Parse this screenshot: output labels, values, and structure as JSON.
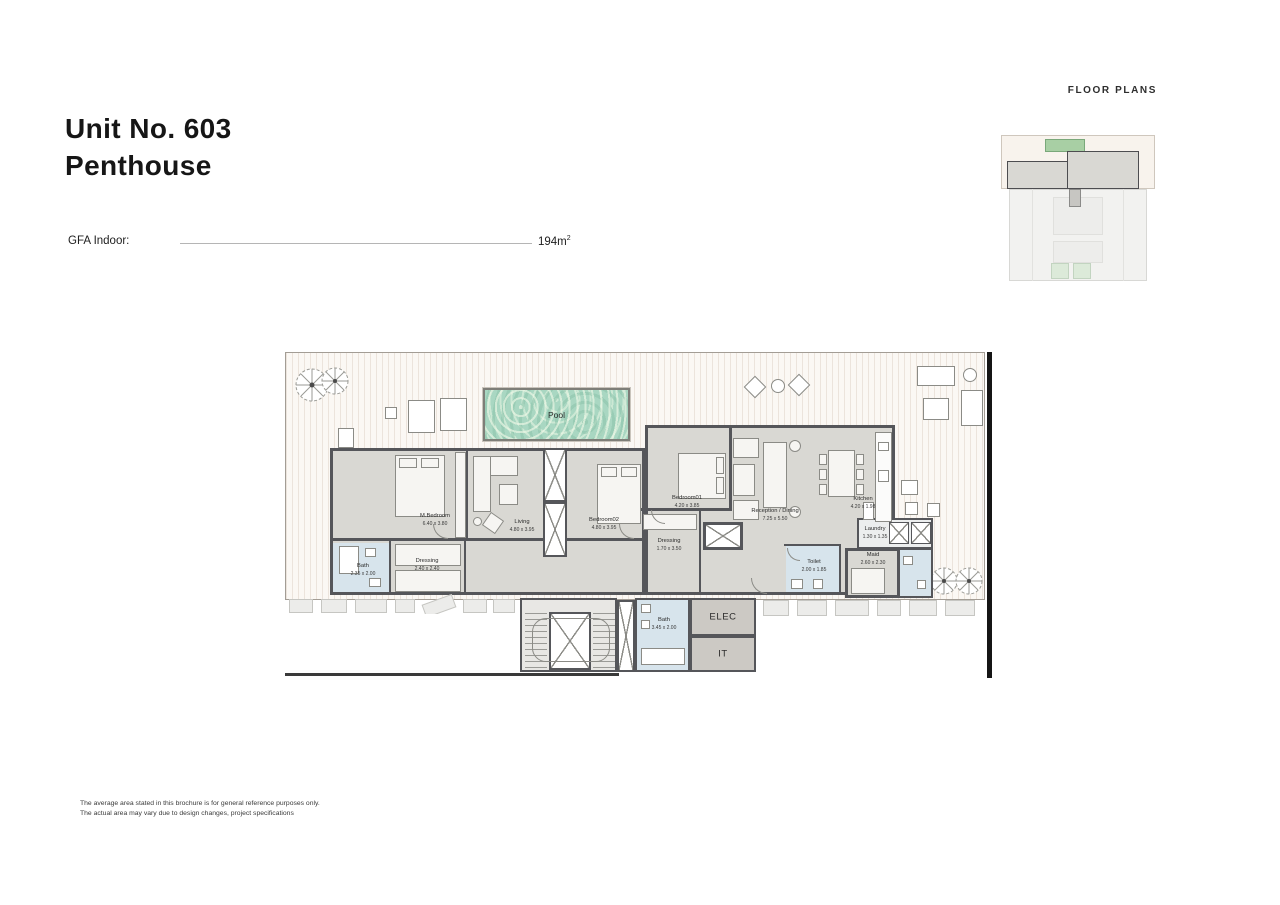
{
  "page": {
    "header_label": "FLOOR PLANS",
    "title_line1": "Unit No. 603",
    "title_line2": "Penthouse",
    "gfa": {
      "label": "GFA Indoor:",
      "value": "194m",
      "sup": "2"
    },
    "disclaimer_line1": "The average area stated in this brochure is for general reference purposes only.",
    "disclaimer_line2": "The actual area may vary due to design changes, project specifications"
  },
  "plan": {
    "pool_label": "Pool",
    "rooms": [
      {
        "name": "M.Bedroom",
        "dims": "6.40 x 3.80"
      },
      {
        "name": "Living",
        "dims": "4.80 x 3.95"
      },
      {
        "name": "Bedroom02",
        "dims": "4.80 x 3.95"
      },
      {
        "name": "Bedroom01",
        "dims": "4.20 x 3.85"
      },
      {
        "name": "Reception / Dining",
        "dims": "7.25 x 5.50"
      },
      {
        "name": "Kitchen",
        "dims": "4.20 x 1.98"
      },
      {
        "name": "Dressing",
        "dims": "2.40 x 2.40"
      },
      {
        "name": "Bath",
        "dims": "2.35 x 2.00"
      },
      {
        "name": "Dressing",
        "dims": "1.70 x 3.50"
      },
      {
        "name": "Toilet",
        "dims": "2.00 x 1.85"
      },
      {
        "name": "Maid",
        "dims": "2.60 x 2.30"
      },
      {
        "name": "Laundry",
        "dims": "1.30 x 1.35"
      },
      {
        "name": "Bath",
        "dims": "3.45 x 2.00"
      },
      {
        "name": "ELEC"
      },
      {
        "name": "IT"
      }
    ],
    "colors": {
      "wall": "#55565a",
      "interior_fill": "#d9d8d3",
      "wet_area_fill": "#d7e4ec",
      "pool_water": "#a9d7c2",
      "terrace": "#fbf8f4",
      "technical_fill": "#ccc9c4",
      "section_marker": "#151515"
    }
  }
}
